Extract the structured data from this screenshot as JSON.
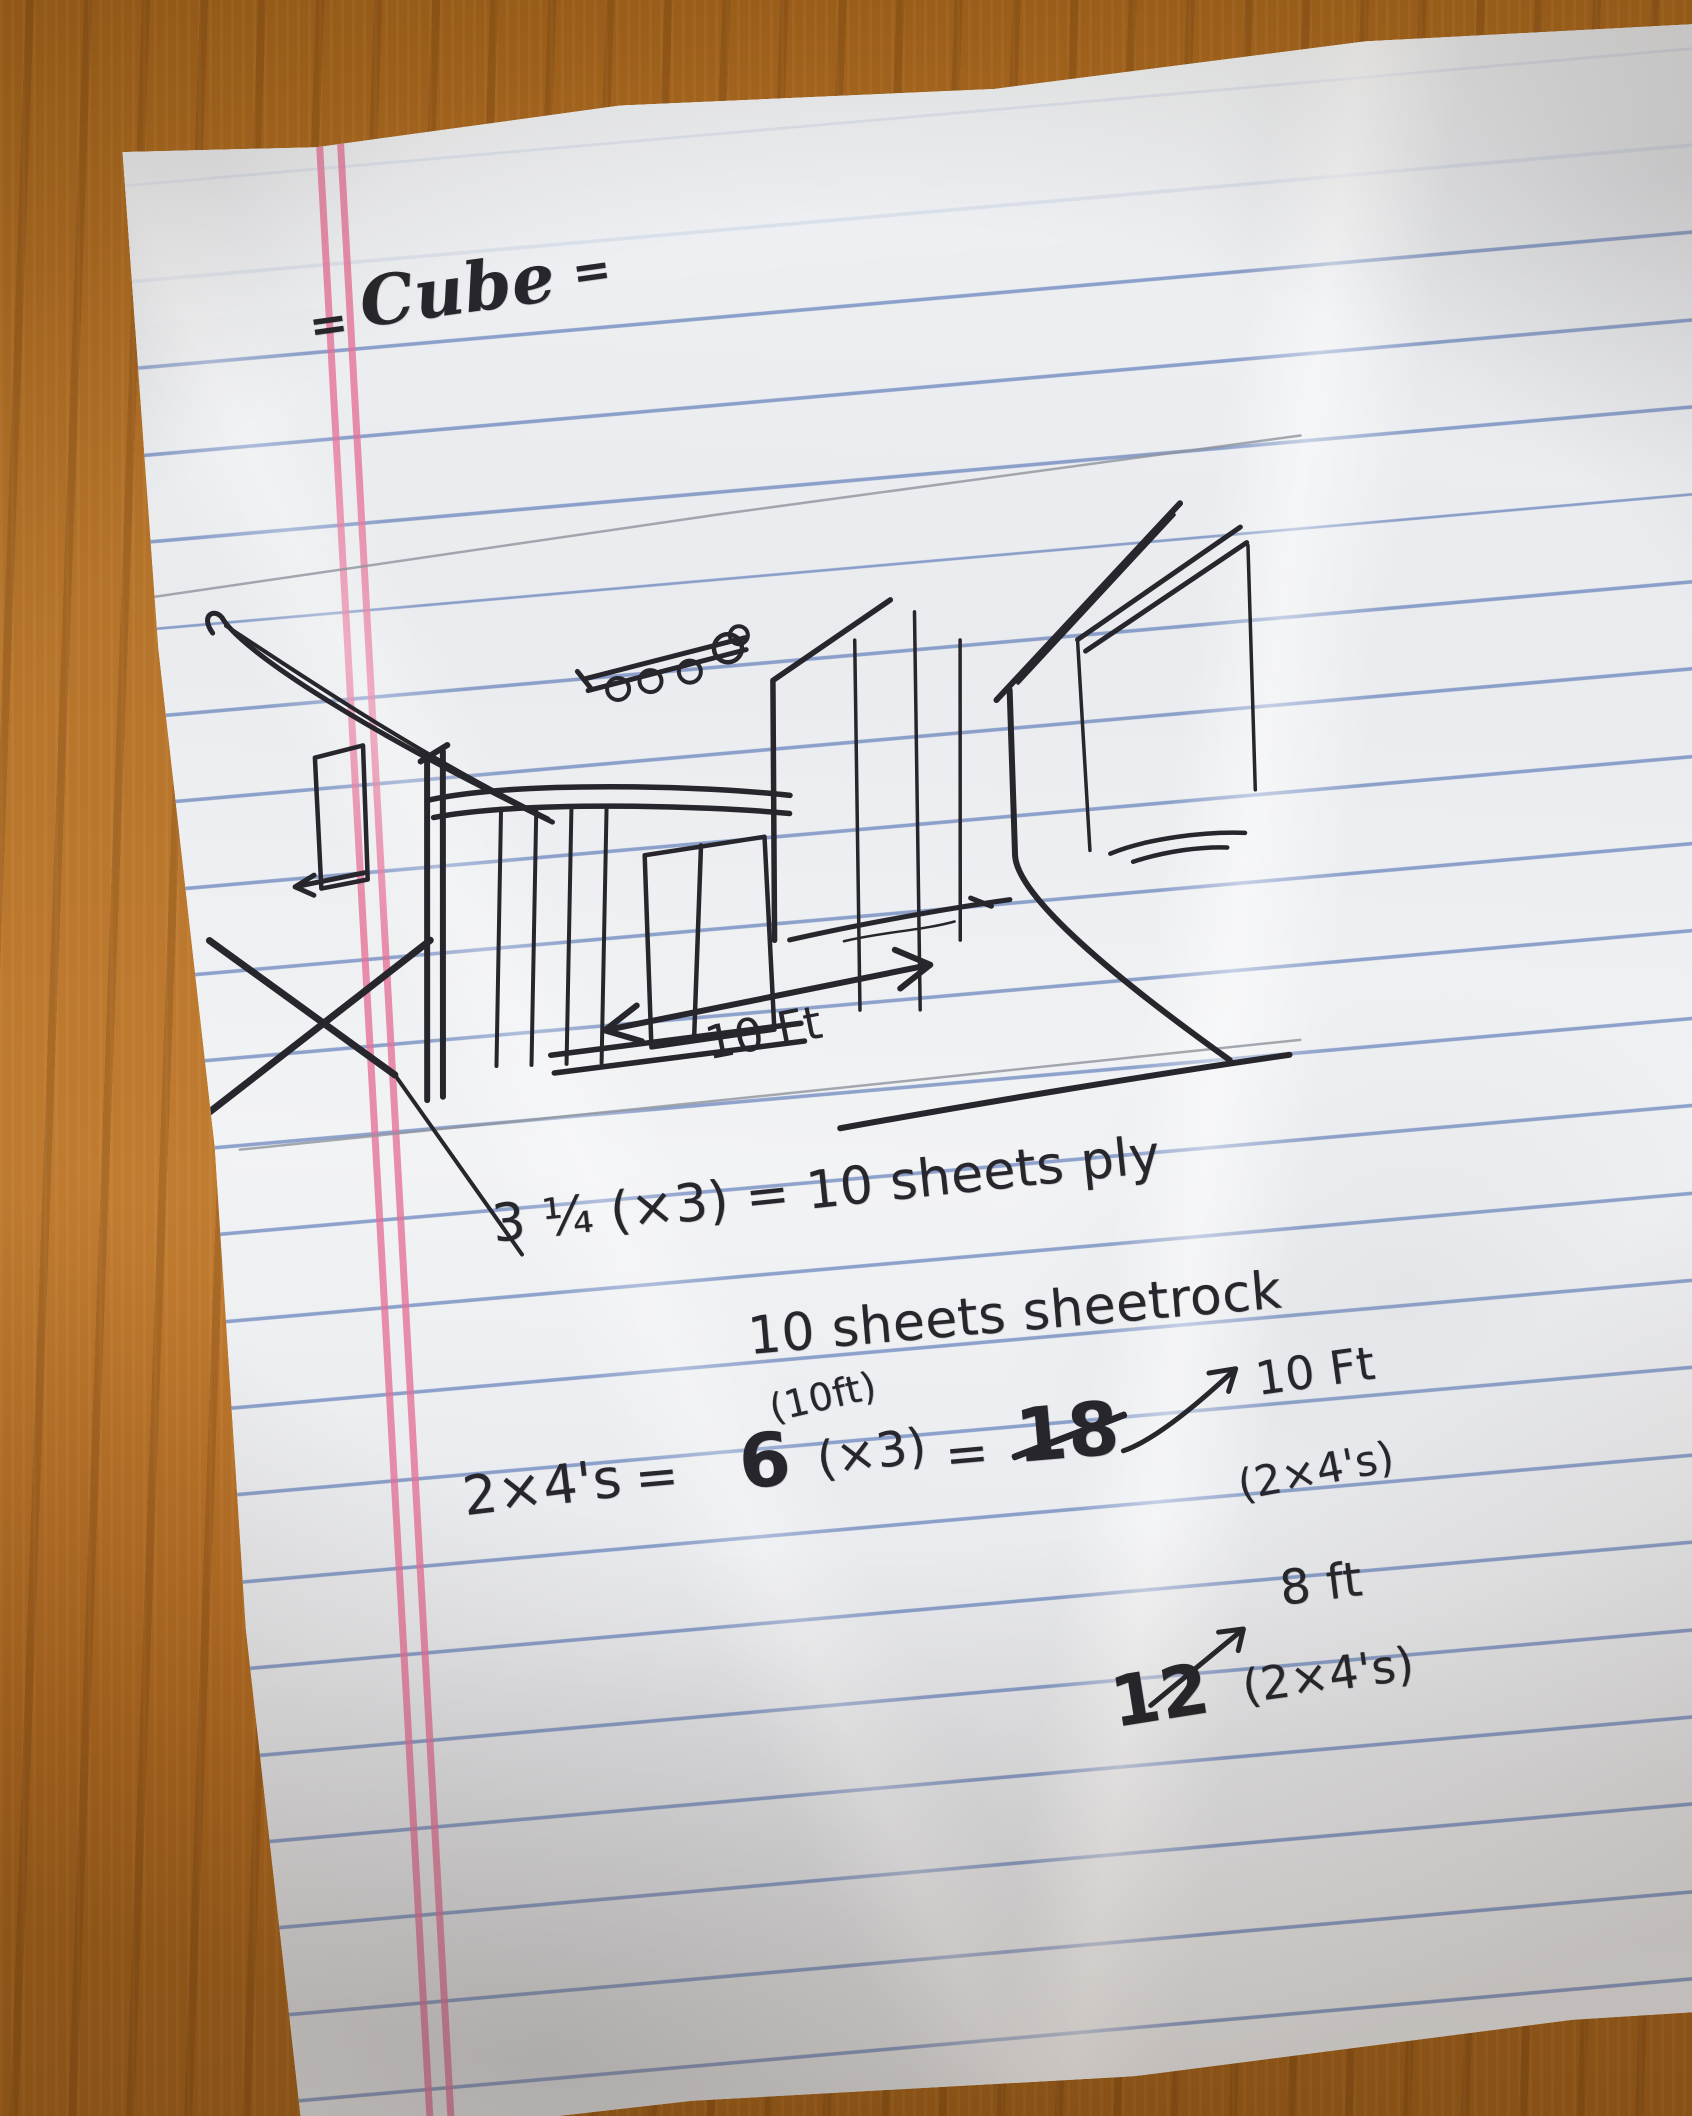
{
  "photo": {
    "colors": {
      "wood_table": "#b5742b",
      "paper": "#edeef1",
      "rule_blue": "#3c60aa",
      "margin_pink": "#e57096",
      "ink": "#26262c",
      "pencil": "#8e949c"
    }
  },
  "note": {
    "title": {
      "left_mark": "=",
      "word": "Cube",
      "right_mark": "="
    },
    "sketch": {
      "dimension_label": "10 Ft"
    },
    "calc": {
      "ply_line": "3 ¼ (×3) = 10 sheets ply",
      "sheetrock_line": "10 sheets sheetrock",
      "lumber_label": "2×4's",
      "equals": "=",
      "over_note": "(10ft)",
      "first_count": "6",
      "times_three": "(×3)",
      "crossed_out_count": "18",
      "len10_label": "10 Ft",
      "lumber_note": "(2×4's)",
      "len8_label": "8 ft",
      "final_count": "12"
    }
  }
}
